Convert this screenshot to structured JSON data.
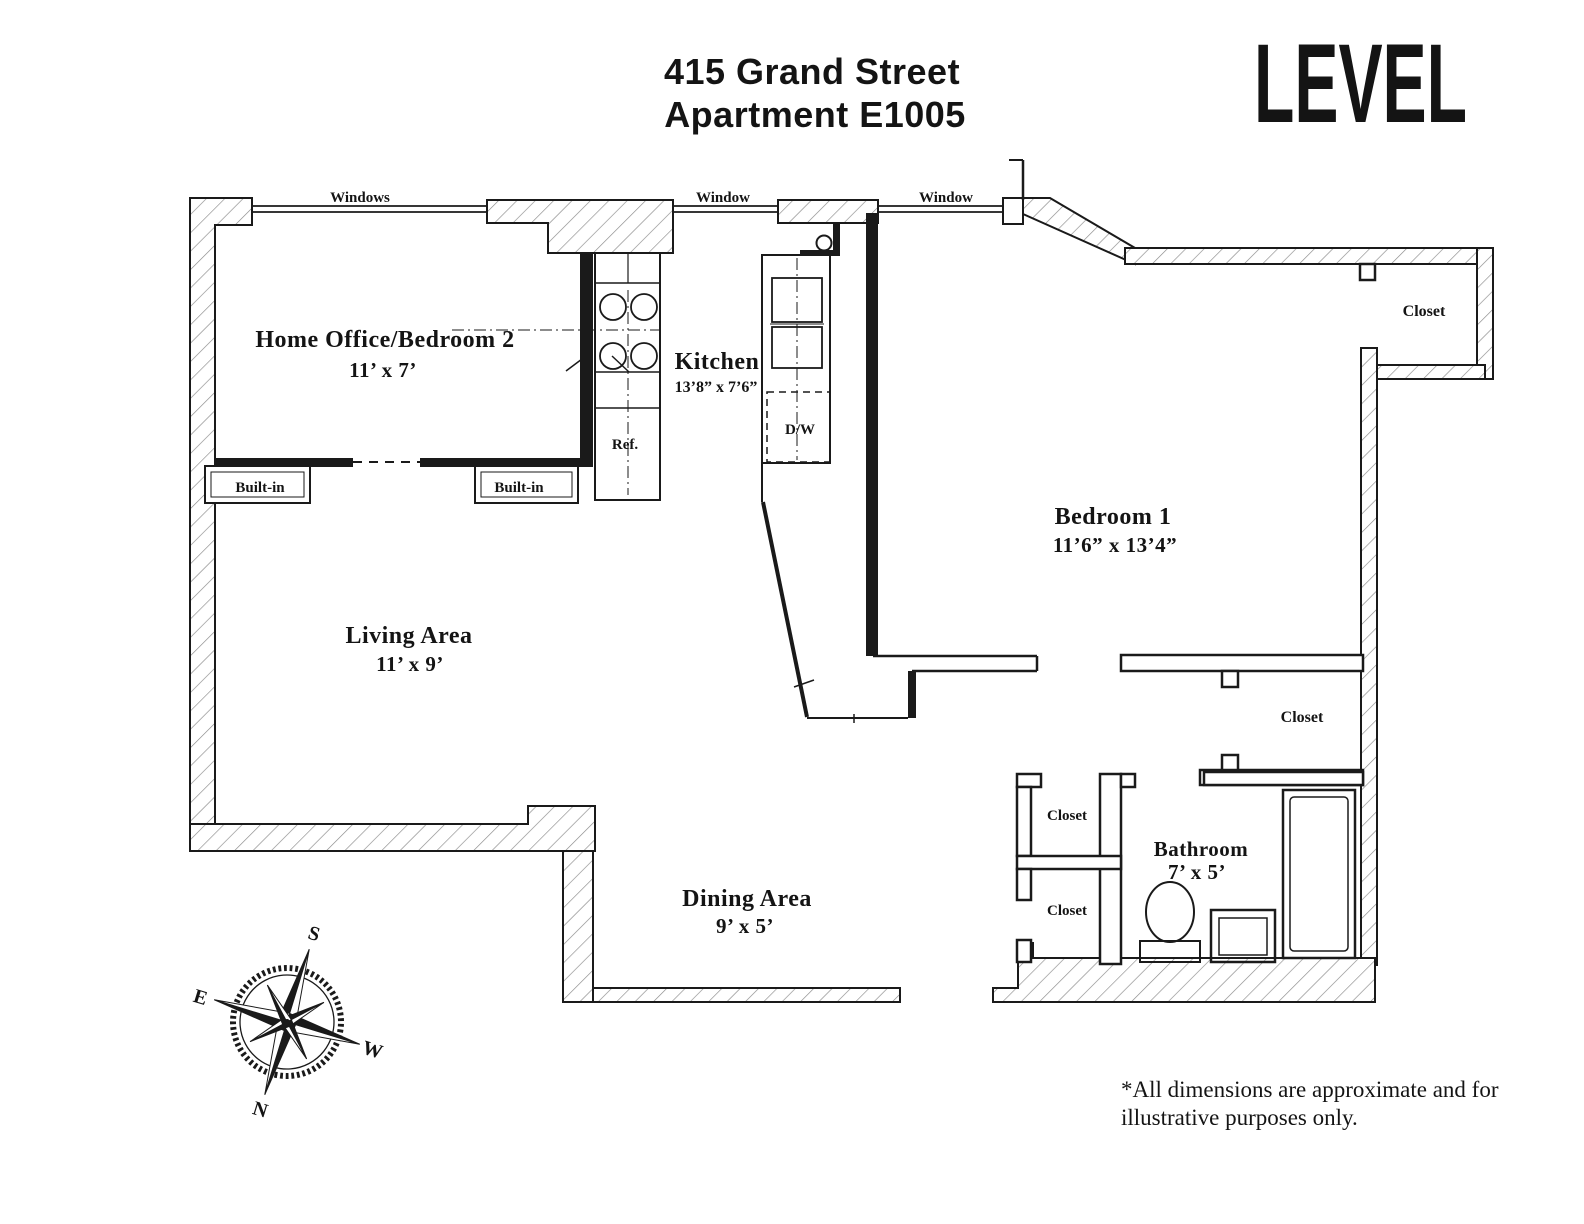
{
  "header": {
    "address_line1": "415 Grand Street",
    "address_line2": "Apartment E1005",
    "brand": "LEVEL"
  },
  "rooms": {
    "home_office": {
      "name": "Home Office/Bedroom 2",
      "dims": "11’ x 7’"
    },
    "kitchen": {
      "name": "Kitchen",
      "dims": "13’8” x 7’6”"
    },
    "bedroom1": {
      "name": "Bedroom 1",
      "dims": "11’6” x 13’4”"
    },
    "living": {
      "name": "Living Area",
      "dims": "11’ x 9’"
    },
    "dining": {
      "name": "Dining Area",
      "dims": "9’ x 5’"
    },
    "bathroom": {
      "name": "Bathroom",
      "dims": "7’ x 5’"
    }
  },
  "fixtures": {
    "refrigerator": "Ref.",
    "dishwasher": "D/W"
  },
  "features": {
    "windows": "Windows",
    "window": "Window",
    "built_in": "Built-in",
    "closet": "Closet"
  },
  "compass": {
    "north": "N",
    "south": "S",
    "east": "E",
    "west": "W"
  },
  "disclaimer": {
    "line1": "*All dimensions are approximate and for",
    "line2": "illustrative purposes only."
  },
  "colors": {
    "wall": "#1a1a1a",
    "hatch": "#8a8a8a"
  }
}
